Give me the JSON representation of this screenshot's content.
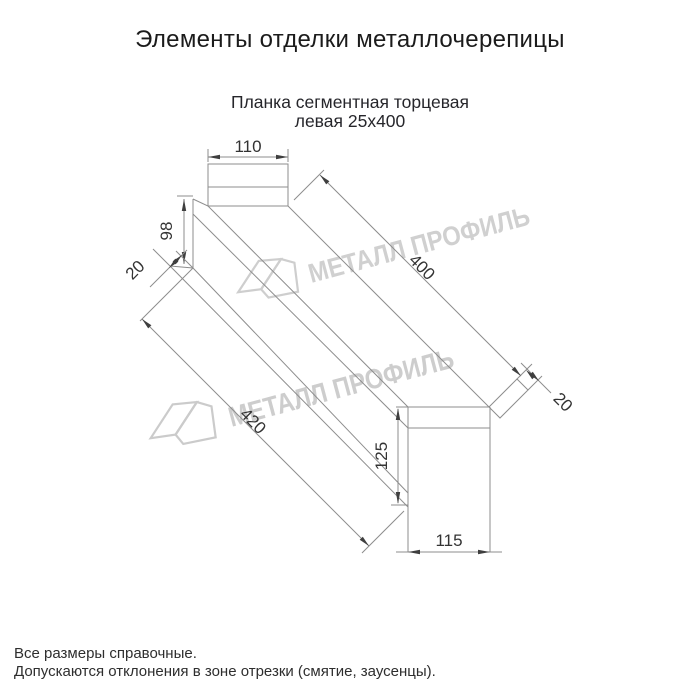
{
  "header": {
    "title": "Элементы отделки металлочерепицы"
  },
  "drawing": {
    "subtitle": {
      "line1": "Планка сегментная торцевая",
      "line2": "левая 25х400"
    },
    "dimensions": {
      "top_width": "110",
      "left_end_height": "98",
      "left_hem": "20",
      "top_length": "400",
      "right_hem": "20",
      "bottom_length": "420",
      "right_end_height": "125",
      "bottom_width": "115"
    }
  },
  "watermark": {
    "text": "МЕТАЛЛ ПРОФИЛЬ",
    "color": "#c8c8c8"
  },
  "footnotes": {
    "line1": "Все размеры справочные.",
    "line2": "Допускаются отклонения в зоне отрезки (смятие, заусенцы)."
  },
  "colors": {
    "line_gray": "#8d8d8d",
    "dim_text": "#333333",
    "title": "#1b1b1b",
    "subtitle": "#26262b",
    "background": "#ffffff"
  }
}
